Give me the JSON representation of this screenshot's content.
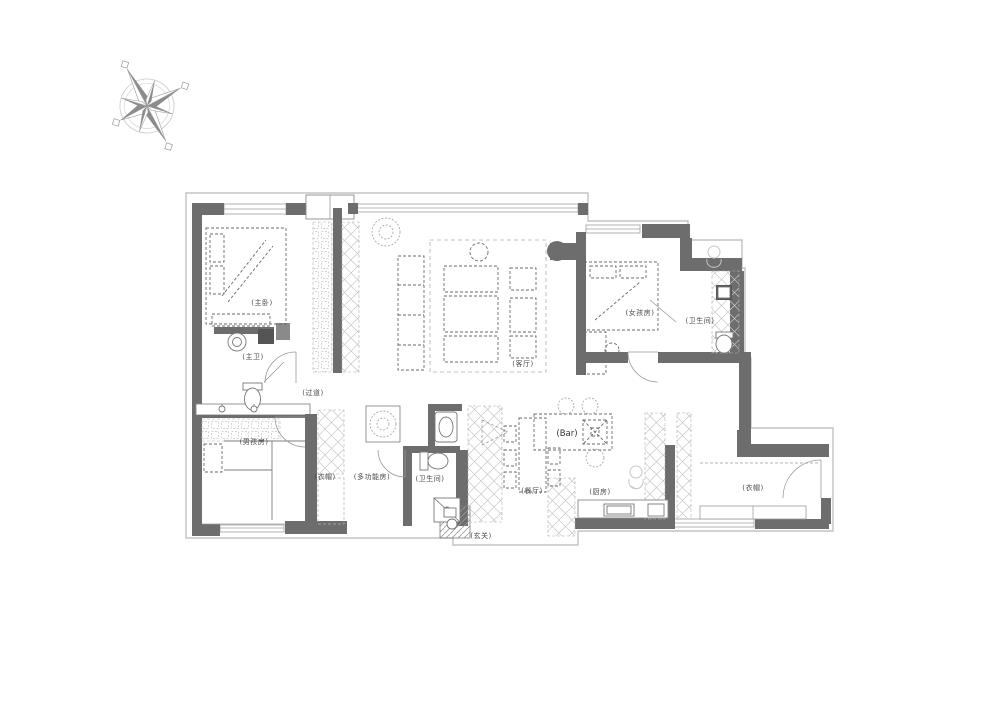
{
  "title": "apartment-floor-plan",
  "compass": {
    "name": "compass-rose"
  },
  "rooms": {
    "master_bedroom": "(主卧)",
    "master_bath": "(主卫)",
    "hallway": "(过道)",
    "living_room": "(客厅)",
    "girls_room": "(女孩房)",
    "girls_bathroom": "(卫生间)",
    "boys_room": "(男孩房)",
    "closet": "(衣帽)",
    "multi_function_room": "(多功能房)",
    "center_bathroom": "(卫生间)",
    "dining_room": "(餐厅)",
    "bar": "(Bar)",
    "kitchen": "(厨房)",
    "foyer": "(玄关)",
    "entry_cloakroom": "(衣帽)"
  },
  "colors": {
    "background": "#ffffff",
    "wall": "#6d6d6d",
    "plan_outline": "#b8b8b8",
    "furniture_dash": "#666666",
    "cabinet_hatch": "#c8c8c8",
    "label_text": "#4a4a4a"
  }
}
